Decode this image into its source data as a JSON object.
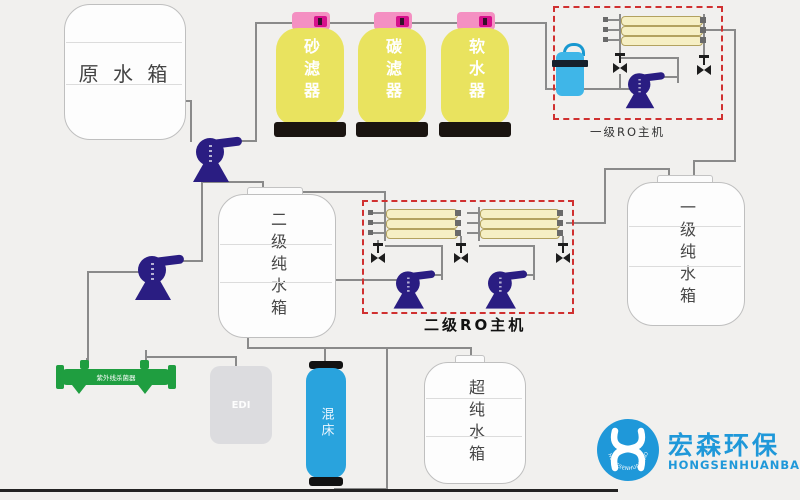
{
  "diagram": {
    "title_hint": "RO ultra-pure water treatment process flow diagram",
    "colors": {
      "background": "#f1f0ee",
      "pipe": "#8a8a8a",
      "dashed_box_red": "#d03030",
      "pump_indigo": "#2a1d82",
      "filter_yellow": "#e9e35f",
      "filter_cap_pink": "#f490c2",
      "membrane_yellow": "#f6efc4",
      "uv_green": "#1f9e40",
      "mixed_bed_blue": "#29a3dd",
      "precision_filter_blue": "#3fb6e8",
      "logo_blue": "#1f98d9"
    },
    "tanks": {
      "raw": "原 水 箱",
      "stage2_pure": "二级纯水箱",
      "stage1_pure": "一级纯水箱",
      "ultra_pure": "超纯水箱",
      "edi": "EDI",
      "mixed_bed": "混床"
    },
    "filters": [
      {
        "label": "砂滤器"
      },
      {
        "label": "碳滤器"
      },
      {
        "label": "软水器"
      }
    ],
    "ro_units": {
      "stage1_label": "一级RO主机",
      "stage2_label": "二级RO主机"
    },
    "uv_sterilizer_label": "紫外线杀菌器",
    "logo": {
      "cn": "宏森环保",
      "en": "HONGSENHUANBAO",
      "circle_text": "HONGSENHUANBAO"
    }
  }
}
